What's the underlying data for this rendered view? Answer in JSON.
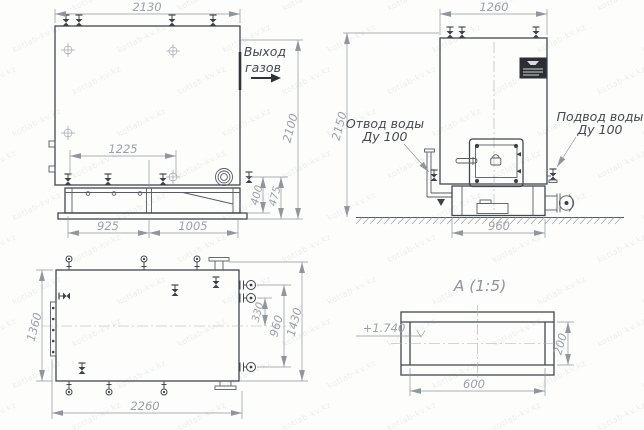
{
  "watermark": {
    "text": "kotlab-kv.kz"
  },
  "front_view": {
    "dim_width": "2130",
    "dim_height": "2100",
    "dim_inner": "1225",
    "dim_base_left": "925",
    "dim_base_right": "1005",
    "dim_base_h1": "400",
    "dim_base_h2": "475",
    "label_gas_1": "Выход",
    "label_gas_2": "газов"
  },
  "side_view": {
    "dim_width": "1260",
    "dim_height": "2150",
    "dim_base": "960",
    "label_outlet_1": "Отвод воды",
    "label_outlet_2": "Ду 100",
    "label_inlet_1": "Подвод воды",
    "label_inlet_2": "Ду 100"
  },
  "top_view": {
    "dim_height": "1360",
    "dim_width": "2260",
    "dim_330": "330",
    "dim_960": "960",
    "dim_1430": "1430"
  },
  "detail_view": {
    "title": "А (1:5)",
    "dim_width": "600",
    "dim_height": "200",
    "level": "+1.740"
  }
}
